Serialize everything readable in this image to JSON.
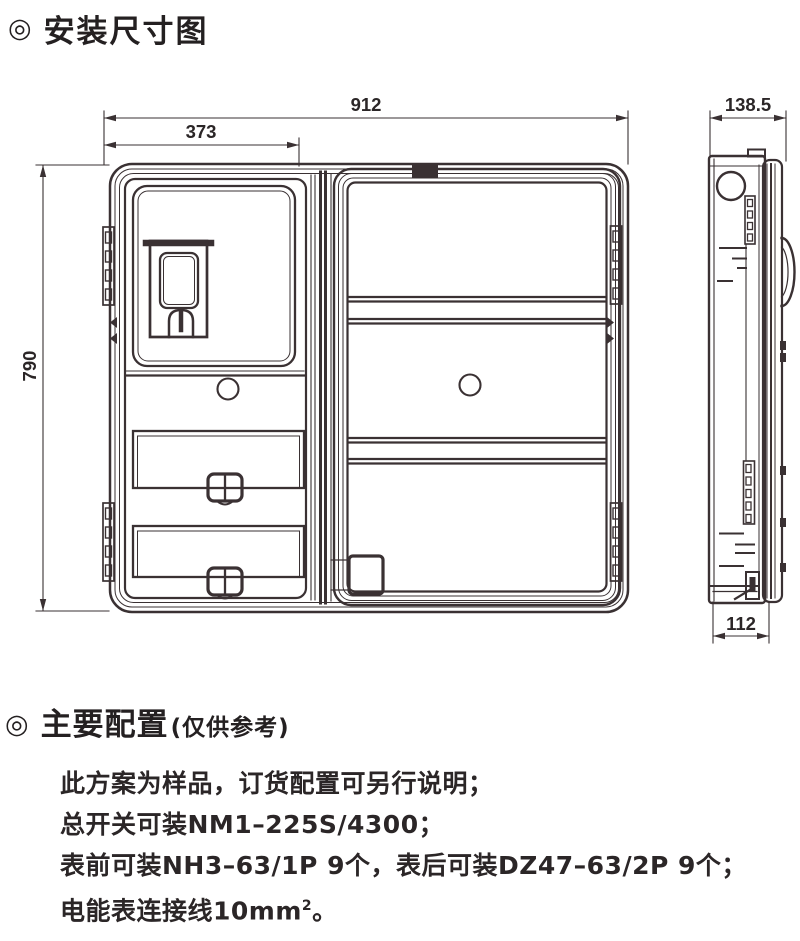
{
  "install_section": {
    "bullet": "◎",
    "title": "安装尺寸图"
  },
  "config_section": {
    "bullet": "◎",
    "title": "主要配置",
    "subtitle": "(仅供参考)",
    "lines": [
      "此方案为样品，订货配置可另行说明；",
      "总开关可装NM1–225S/4300；",
      "表前可装NH3–63/1P 9个，表后可装DZ47–63/2P  9个；"
    ],
    "line4": {
      "pre": "电能表连接线10mm",
      "sup": "2",
      "post": "。"
    }
  },
  "diagram": {
    "front_view": {
      "width_total": "912",
      "width_left_section": "373",
      "height": "790"
    },
    "side_view": {
      "depth_top": "138.5",
      "depth_bottom": "112"
    },
    "colors": {
      "line": "#3a3133",
      "text": "#2b2627"
    }
  }
}
